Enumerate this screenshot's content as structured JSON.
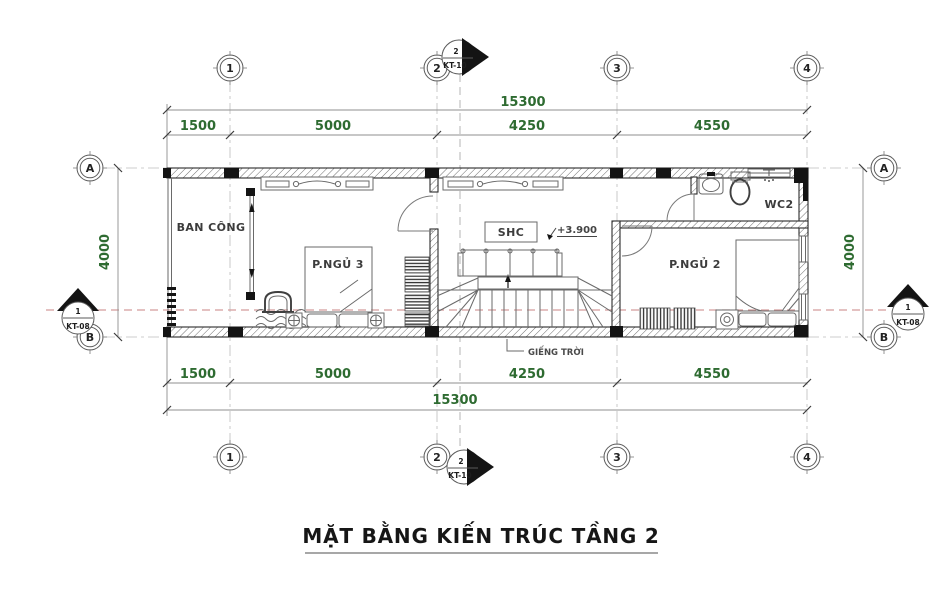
{
  "title": "MẶT BẰNG KIẾN TRÚC TẦNG 2",
  "grid": {
    "columns": [
      "1",
      "2",
      "3",
      "4"
    ],
    "rows": [
      "A",
      "B"
    ]
  },
  "dimensions": {
    "total_width": "15300",
    "segments": [
      "1500",
      "5000",
      "4250",
      "4550"
    ],
    "side_height": "4000"
  },
  "rooms": {
    "balcony": "BAN CÔNG",
    "bedroom3": "P.NGỦ 3",
    "living": "SHC",
    "wc": "WC2",
    "bedroom2": "P.NGỦ 2"
  },
  "annotations": {
    "level": "+3.900",
    "skylight": "GIẾNG TRỜI"
  },
  "sections": {
    "kt10": {
      "number": "2",
      "code": "KT-10"
    },
    "kt08": {
      "number": "1",
      "code": "KT-08"
    }
  },
  "colors": {
    "dimension_text": "#2e6b31",
    "section_cut_line": "#d49c9c",
    "wall_ink": "#2b2b2b",
    "background": "#ffffff"
  }
}
